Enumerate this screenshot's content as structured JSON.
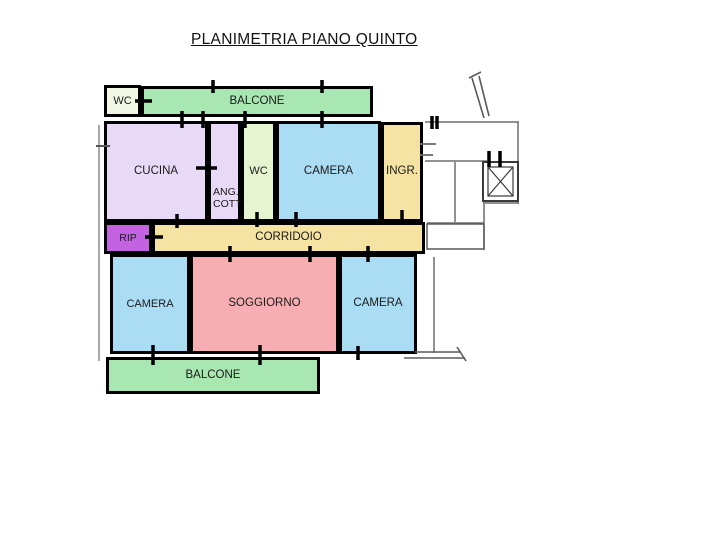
{
  "title": "PLANIMETRIA PIANO QUINTO",
  "rooms": {
    "wc_top": "WC",
    "balcone_top": "BALCONE",
    "cucina": "CUCINA",
    "ang_cott": "ANG. COTT",
    "wc_mid": "WC",
    "camera_top": "CAMERA",
    "ingresso": "INGR.",
    "rip": "RIP",
    "corridoio": "CORRIDOIO",
    "camera_left": "CAMERA",
    "soggiorno": "SOGGIORNO",
    "camera_right": "CAMERA",
    "balcone_bottom": "BALCONE"
  },
  "colors": {
    "balcony_green": "#a9e7b2",
    "wc_cream": "#f3f8e4",
    "wc_green": "#e6f4d0",
    "kitchen_lavender": "#e8daf6",
    "bedroom_blue": "#aadcf3",
    "entry_corridor_yellow": "#f5e3a3",
    "storage_magenta": "#c363e2",
    "living_pink": "#f6aeb3",
    "wall_black": "#000000",
    "pencil_gray": "#6e6e6e"
  }
}
